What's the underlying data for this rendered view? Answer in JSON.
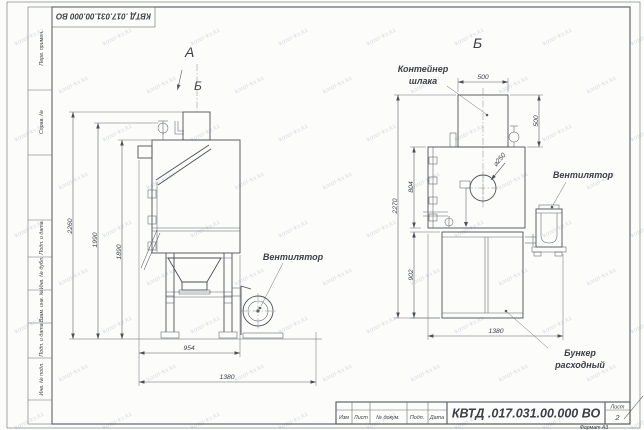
{
  "sheet": {
    "top_designation": "КВТД .017.031.00.000  ВО",
    "format_note": "Формат А3",
    "watermark_text": "kotel-kv.kz"
  },
  "side_column": {
    "items": [
      "Перв. примен.",
      "Справ. №",
      "Подп. и дата",
      "Инв. № дубл.",
      "Взам. инв. №",
      "Подп. и дата",
      "Инв. № подл."
    ]
  },
  "title_block": {
    "designation": "КВТД .017.031.00.000  ВО",
    "columns": [
      "Изм",
      "Лист",
      "№ докум.",
      "Подп.",
      "Дата"
    ],
    "sheet_label": "Лист",
    "sheet_number": "2"
  },
  "views": {
    "left": {
      "label": "А",
      "direction_label": "Б",
      "fan_label": "Вентилятор",
      "dims": {
        "height_overall": "2260",
        "height_mid": "1990",
        "height_body": "1890",
        "width_body": "954",
        "width_overall": "1380"
      }
    },
    "right": {
      "label": "Б",
      "container_label_1": "Контейнер",
      "container_label_2": "шлака",
      "fan_label": "Вентилятор",
      "hopper_label_1": "Бункер",
      "hopper_label_2": "расходный",
      "dims": {
        "container_width": "500",
        "container_height": "500",
        "height_overall": "2270",
        "body_height": "804",
        "hopper_height": "902",
        "width_overall": "1380",
        "hole_dia": "⌀250"
      }
    }
  }
}
